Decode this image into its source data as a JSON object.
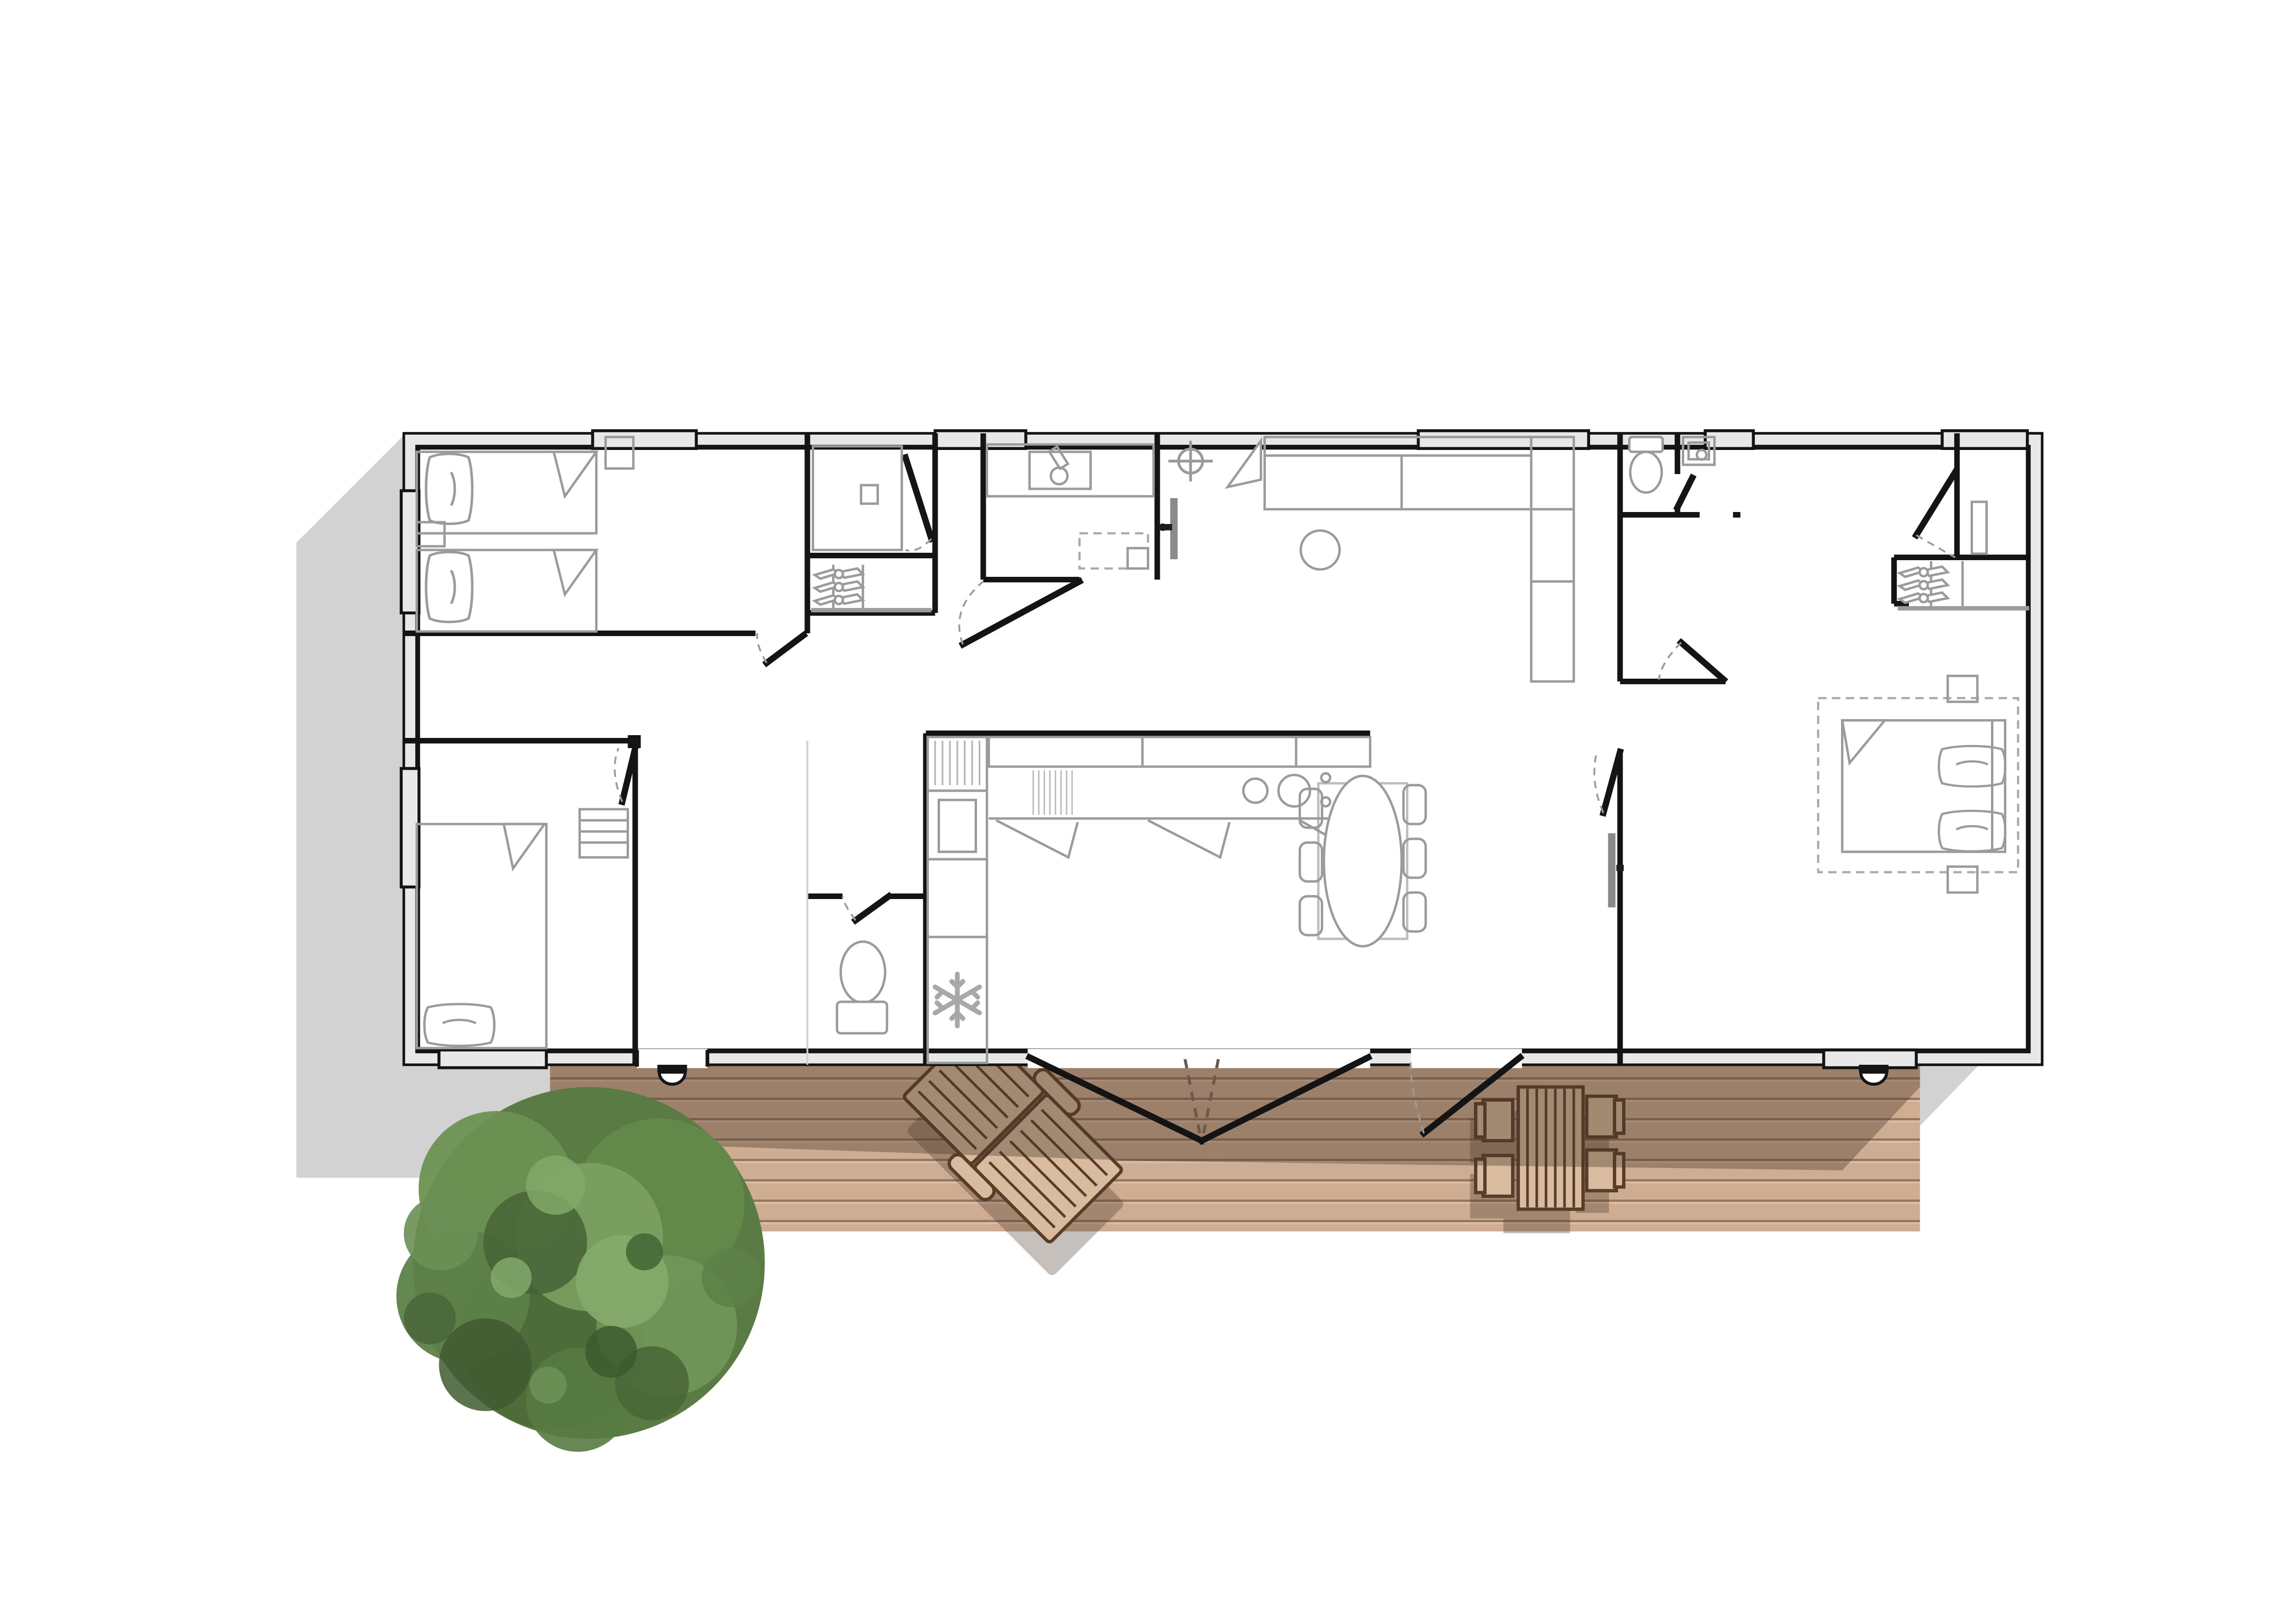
{
  "page": {
    "kind": "architectural-floor-plan-top-view",
    "background": "#ffffff",
    "text_labels": []
  },
  "colors": {
    "wall_line": "#141414",
    "wall_fill": "#e8e8e8",
    "furniture_line": "#9b9b9b",
    "shadow": "#d2d2d2",
    "deck_base": "#cfae94",
    "deck_light": "#dcc0a8",
    "plank_line": "#7a5a42",
    "deck_shadow": "rgba(74,56,42,0.38)",
    "wood_furniture": "#d9bc9f",
    "wood_outline": "#5a3d28",
    "tree_base": "#5a7c44",
    "tree_dark": "#3f5a30",
    "tree_mid": "#648a4b",
    "tree_light": "#85ab6c"
  },
  "building": {
    "shape": "single-storey rectangular unit, top-down plan",
    "rooms": [
      {
        "name": "bedroom-twin",
        "position": "top-left",
        "furniture": [
          "single-bed",
          "single-bed",
          "nightstand",
          "side-table"
        ],
        "windows": 2
      },
      {
        "name": "bedroom-second",
        "position": "bottom-left",
        "furniture": [
          "single-bed",
          "dresser"
        ],
        "windows": 2,
        "deck_door": true
      },
      {
        "name": "shower-room",
        "position": "mid-top",
        "furniture": [
          "shower-tray",
          "floor-drain",
          "glass-screen"
        ],
        "doors": 1
      },
      {
        "name": "hall-wardrobe",
        "position": "mid-left",
        "furniture": [
          "wardrobe-3-hangers"
        ]
      },
      {
        "name": "bathroom-vanity",
        "position": "center-top",
        "furniture": [
          "vanity-sink",
          "washer-space-dashed"
        ],
        "doors": 1
      },
      {
        "name": "wc-small",
        "position": "center-bottom-left",
        "furniture": [
          "toilet"
        ],
        "doors": 1
      },
      {
        "name": "kitchen",
        "position": "center-bottom",
        "furniture": [
          "upper-cabinets",
          "counter",
          "hob-2-burners",
          "drawer-unit",
          "tall-oven-unit",
          "fridge-snowflake"
        ]
      },
      {
        "name": "living-room",
        "position": "center",
        "furniture": [
          "corner-sofa-L",
          "round-pouf",
          "wall-tv",
          "ceiling-light-symbol"
        ],
        "windows": 1
      },
      {
        "name": "dining-area",
        "position": "center-right",
        "furniture": [
          "oval-table",
          "chair",
          "chair",
          "chair",
          "chair",
          "chair",
          "chair"
        ],
        "deck_french_doors": true,
        "deck_single_door": true
      },
      {
        "name": "master-suite-wc",
        "position": "right-top",
        "furniture": [
          "toilet"
        ]
      },
      {
        "name": "master-suite-washbasin",
        "position": "right-top",
        "furniture": [
          "washbasin"
        ],
        "windows": 1
      },
      {
        "name": "master-suite-dressing",
        "position": "far-right-top",
        "furniture": [
          "wall-shelf"
        ],
        "windows": 1,
        "doors": 1
      },
      {
        "name": "master-suite-wardrobe",
        "position": "right-middle",
        "furniture": [
          "wardrobe-3-hangers"
        ]
      },
      {
        "name": "master-bedroom",
        "position": "far-right",
        "furniture": [
          "double-bed",
          "pillow",
          "pillow",
          "nightstand",
          "nightstand",
          "dashed-rug",
          "wall-tv"
        ],
        "windows": 1
      }
    ],
    "door_count_visible_leaves": 11,
    "window_count": 8,
    "threshold_steps": 2
  },
  "exterior": {
    "deck": {
      "material": "wood-planks",
      "furniture": [
        "sun-lounger-rotated-45",
        "outdoor-slatted-table",
        "outdoor-chair",
        "outdoor-chair",
        "outdoor-chair",
        "outdoor-chair"
      ],
      "shadow_overlay": "building shadow across upper part of deck"
    },
    "tree": {
      "type": "round-canopy-tree",
      "position": "bottom-left, overlapping deck corner"
    },
    "cast_shadows": [
      "left-of-building",
      "right-of-deck-triangle"
    ]
  }
}
